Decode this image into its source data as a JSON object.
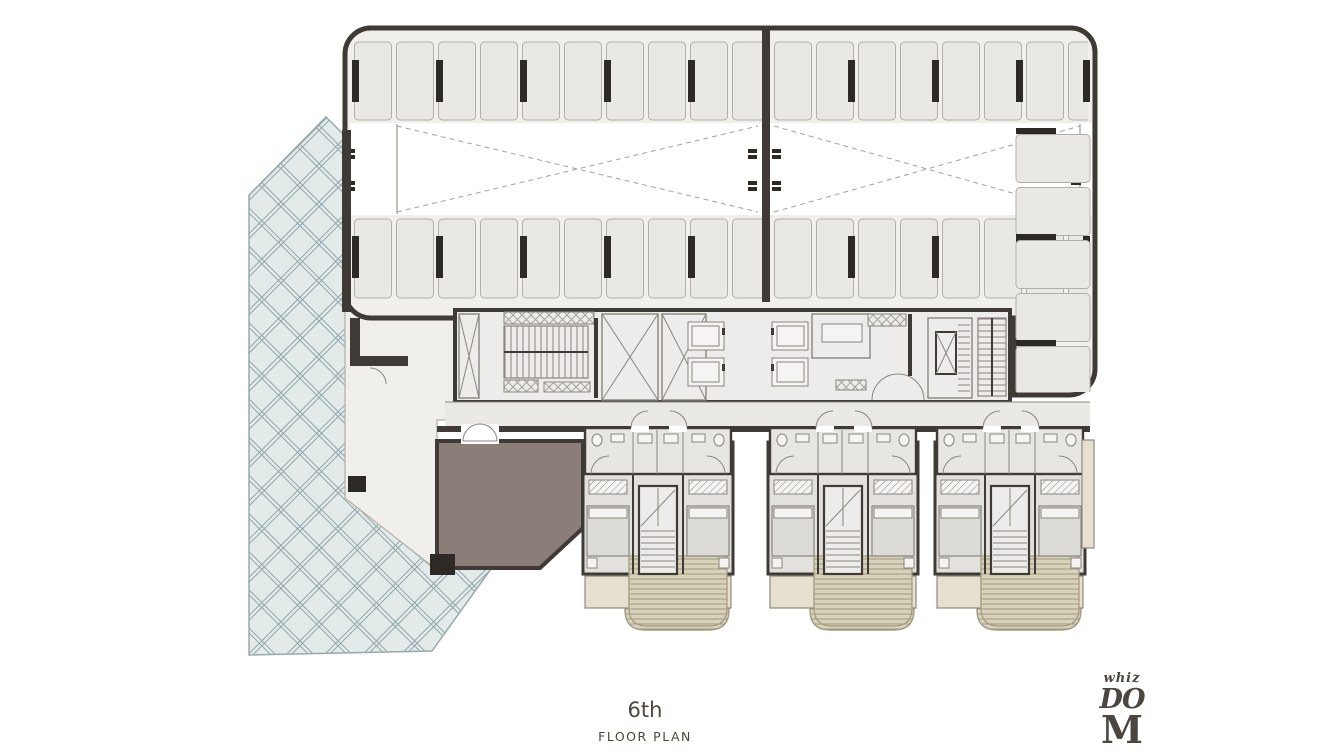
{
  "page": {
    "floor_label": "6th",
    "plan_label": "FLOOR PLAN"
  },
  "logo": {
    "line1": "whiz",
    "line2": "DO",
    "line3": "M"
  },
  "colors": {
    "white": "#ffffff",
    "plate": "#f0efec",
    "stallf": "#e9e8e4",
    "stalls": "#b2afa9",
    "wall": "#3f3a35",
    "coldark": "#2d2a26",
    "latf": "#e3ebea",
    "latl": "#93a4a9",
    "latstroke": "#9aa9ad",
    "unitf": "#e2e1dd",
    "bathf": "#e7e6e2",
    "brown": "#8b7d77",
    "balf": "#e7dfd0",
    "balstroke": "#8f897e",
    "deckf": "#d8d2bc",
    "deckl": "#a19a7e",
    "corrf": "#eae9e6",
    "corefill": "#edecea",
    "bedfill": "#dcdbd7",
    "fixfill": "#f5f4f2",
    "thin": "#8a867e",
    "dash": "#a5a29b",
    "text": "#4c4641"
  }
}
